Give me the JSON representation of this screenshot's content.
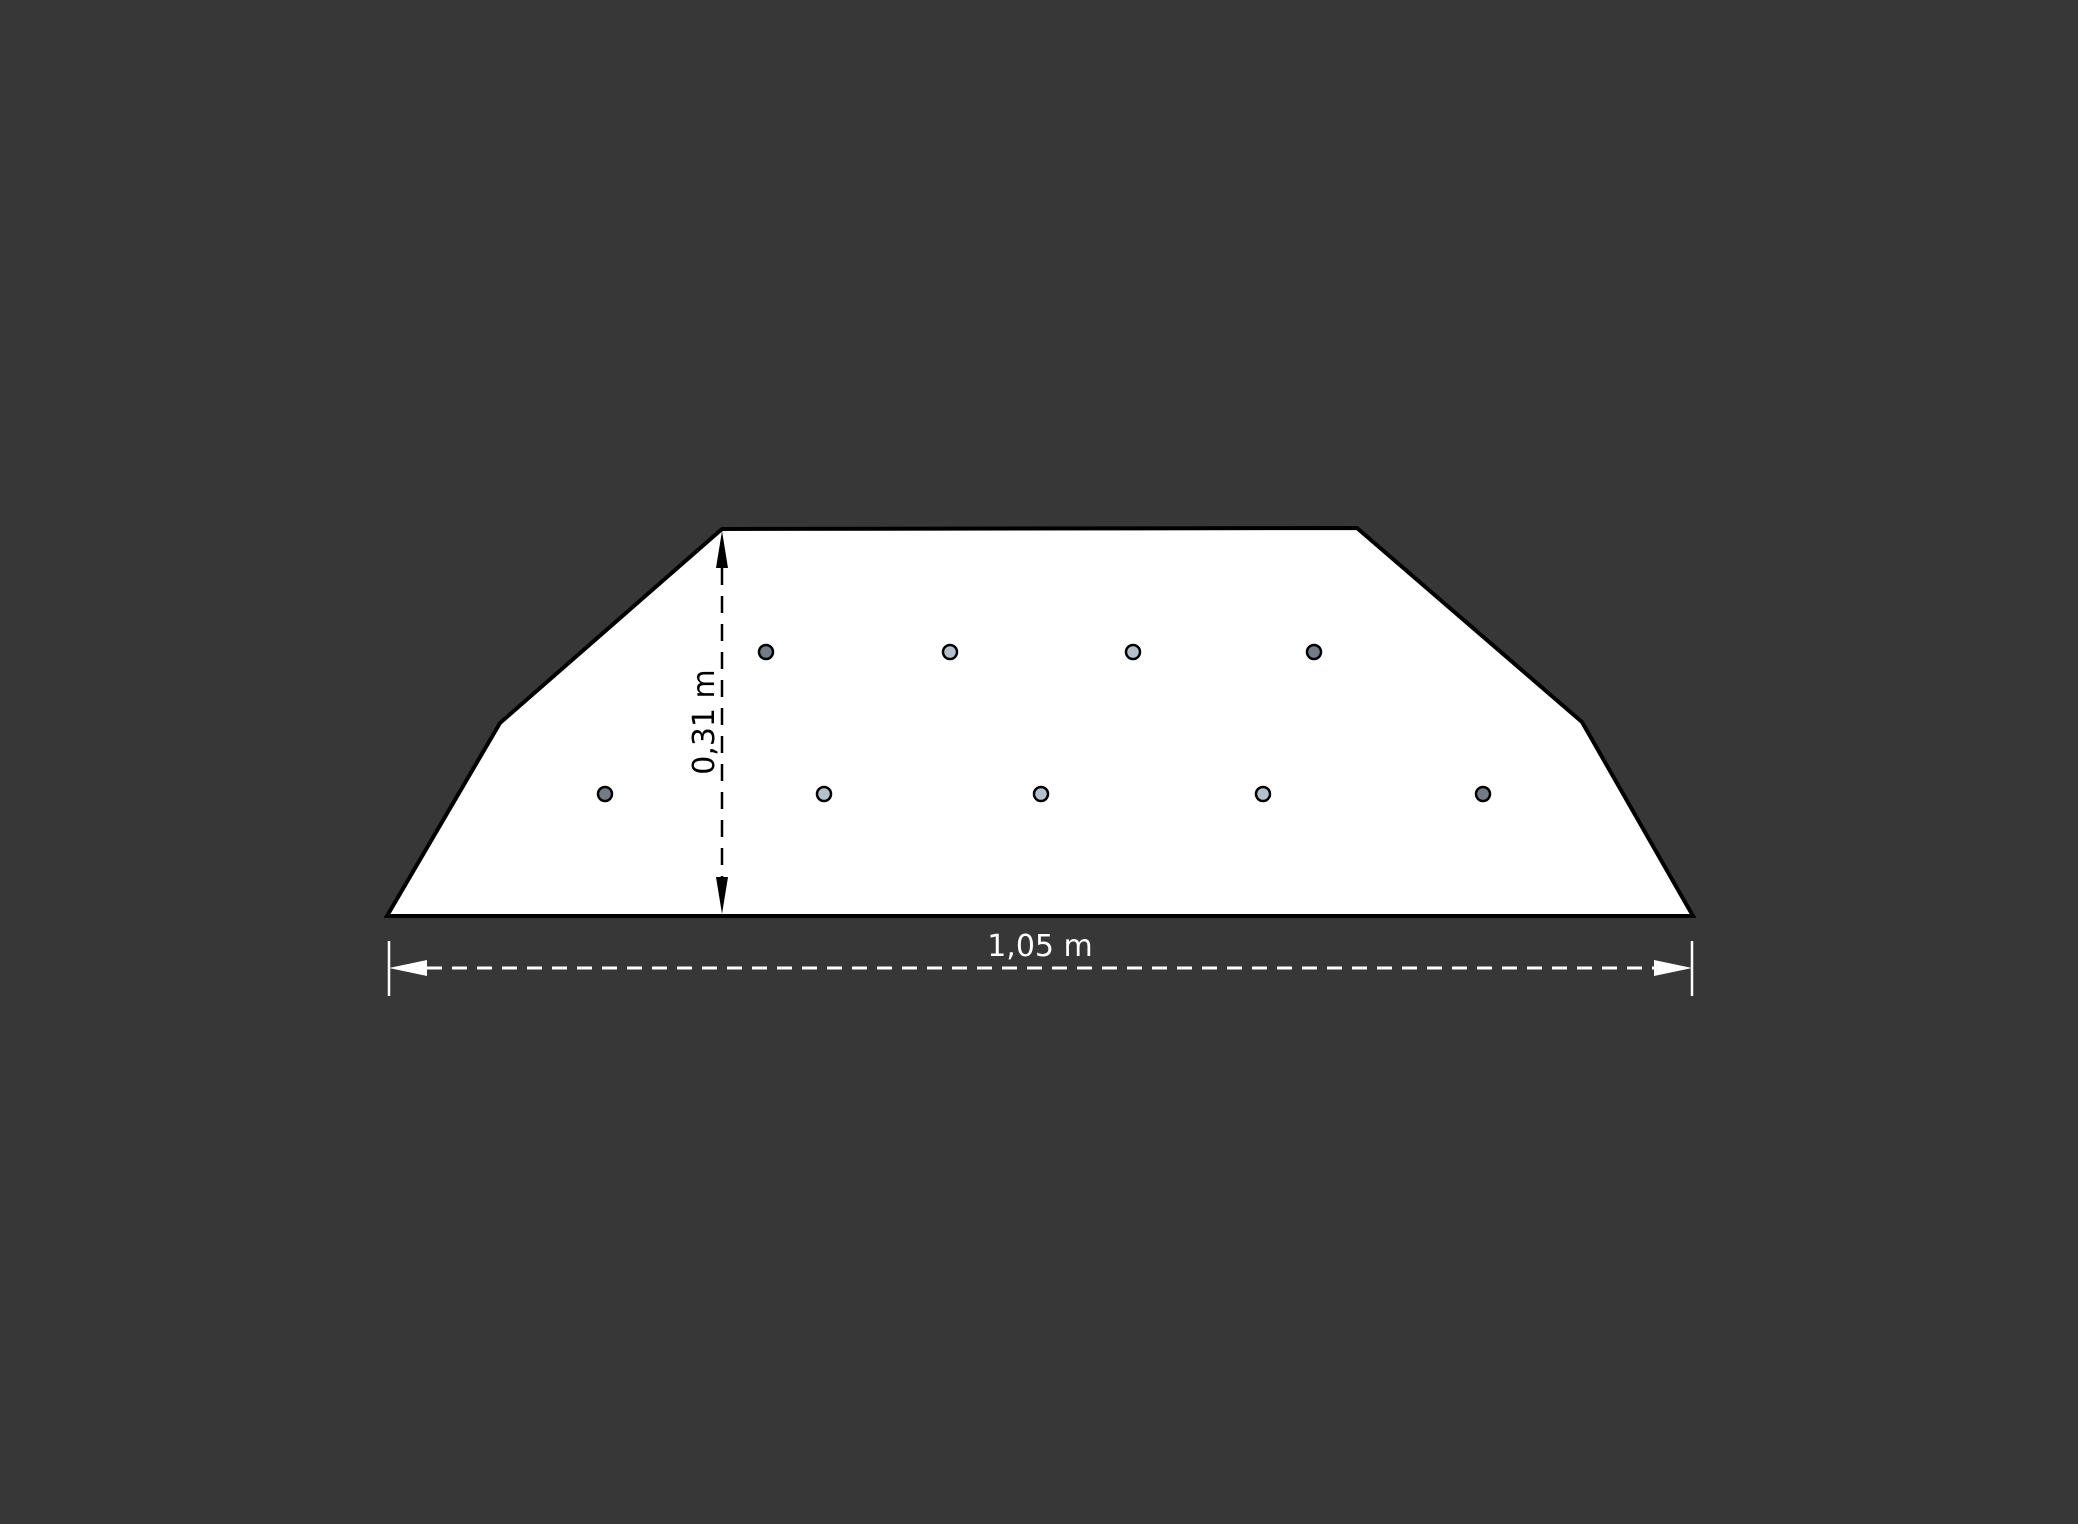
{
  "figure": {
    "background_color": "#373737",
    "shape": {
      "fill": "#ffffff",
      "outline_color": "#000000",
      "outline_width": 4,
      "vertices": [
        [
          387,
          916
        ],
        [
          500,
          723
        ],
        [
          722,
          529
        ],
        [
          1357,
          528
        ],
        [
          1582,
          722
        ],
        [
          1693,
          916
        ]
      ]
    },
    "dots": {
      "radius": 7,
      "outline_color": "#000000",
      "outline_width": 2.5,
      "colors": {
        "dark": "#727b86",
        "light": "#b4c0ca"
      },
      "rows": [
        {
          "y": 652,
          "points": [
            {
              "x": 766,
              "shade": "dark"
            },
            {
              "x": 950,
              "shade": "light"
            },
            {
              "x": 1133,
              "shade": "light"
            },
            {
              "x": 1314,
              "shade": "dark"
            }
          ]
        },
        {
          "y": 794,
          "points": [
            {
              "x": 605,
              "shade": "dark"
            },
            {
              "x": 824,
              "shade": "light"
            },
            {
              "x": 1041,
              "shade": "light"
            },
            {
              "x": 1263,
              "shade": "light"
            },
            {
              "x": 1483,
              "shade": "dark"
            }
          ]
        }
      ]
    },
    "height_dimension": {
      "label": "0,31 m",
      "color": "#000000",
      "x": 722,
      "y_top": 531,
      "y_bottom": 914,
      "dash_pattern": "17 11",
      "line_width": 2.5,
      "arrow_length": 37,
      "arrow_half_width": 6,
      "label_x": 714,
      "label_y": 722,
      "font_size": 30
    },
    "width_dimension": {
      "label": "1,05 m",
      "color": "#ffffff",
      "y": 968,
      "x_left": 389,
      "x_right": 1692,
      "tick_top": 941,
      "tick_bottom": 996,
      "tick_width": 2.5,
      "dash_pattern": "15 10",
      "line_width": 3,
      "arrow_length": 38,
      "arrow_half_width": 8,
      "label_x": 1040,
      "label_y": 956,
      "font_size": 30
    }
  }
}
